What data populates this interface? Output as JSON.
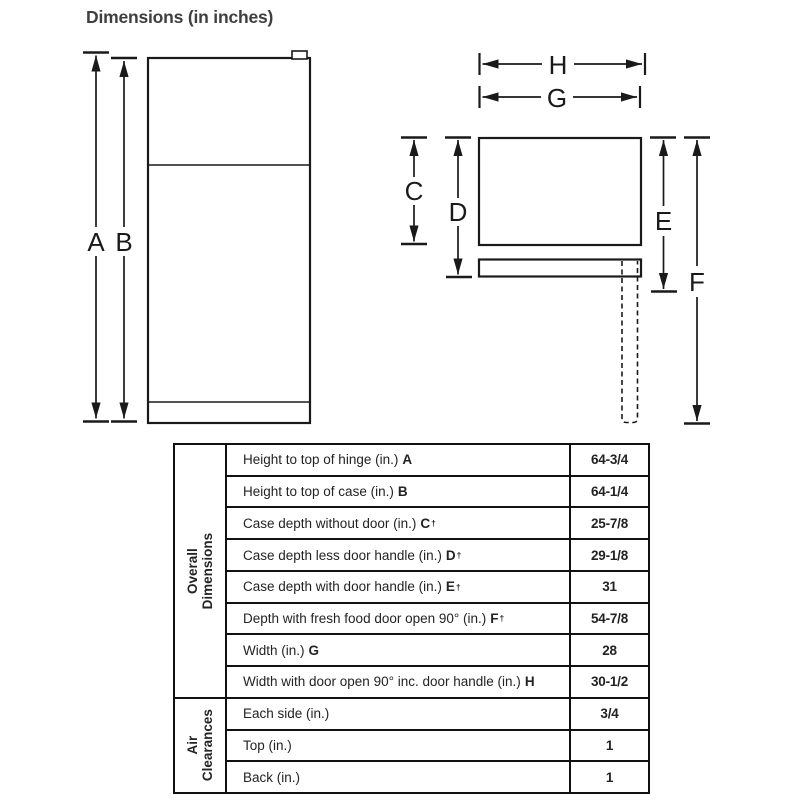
{
  "title": "Dimensions (in inches)",
  "diagram": {
    "front_view": {
      "labels": {
        "a": "A",
        "b": "B"
      }
    },
    "top_view": {
      "labels": {
        "c": "C",
        "d": "D",
        "e": "E",
        "f": "F",
        "g": "G",
        "h": "H"
      }
    }
  },
  "table": {
    "dagger_symbol": "†",
    "sections": [
      {
        "label_lines": [
          "Overall",
          "Dimensions"
        ],
        "rows": [
          {
            "label": "Height to top of hinge (in.)",
            "letter": "A",
            "dagger": false,
            "value": "64-3/4"
          },
          {
            "label": "Height to top of case (in.)",
            "letter": "B",
            "dagger": false,
            "value": "64-1/4"
          },
          {
            "label": "Case depth without door (in.)",
            "letter": "C",
            "dagger": true,
            "value": "25-7/8"
          },
          {
            "label": "Case depth less door handle (in.)",
            "letter": "D",
            "dagger": true,
            "value": "29-1/8"
          },
          {
            "label": "Case depth with door handle (in.)",
            "letter": "E",
            "dagger": true,
            "value": "31"
          },
          {
            "label": "Depth with fresh food door open 90° (in.)",
            "letter": "F",
            "dagger": true,
            "value": "54-7/8"
          },
          {
            "label": "Width (in.)",
            "letter": "G",
            "dagger": false,
            "value": "28"
          },
          {
            "label": "Width with door open 90° inc. door handle (in.)",
            "letter": "H",
            "dagger": false,
            "value": "30-1/2"
          }
        ]
      },
      {
        "label_lines": [
          "Air",
          "Clearances"
        ],
        "rows": [
          {
            "label": "Each side (in.)",
            "letter": "",
            "dagger": false,
            "value": "3/4"
          },
          {
            "label": "Top (in.)",
            "letter": "",
            "dagger": false,
            "value": "1"
          },
          {
            "label": "Back (in.)",
            "letter": "",
            "dagger": false,
            "value": "1"
          }
        ]
      }
    ]
  }
}
